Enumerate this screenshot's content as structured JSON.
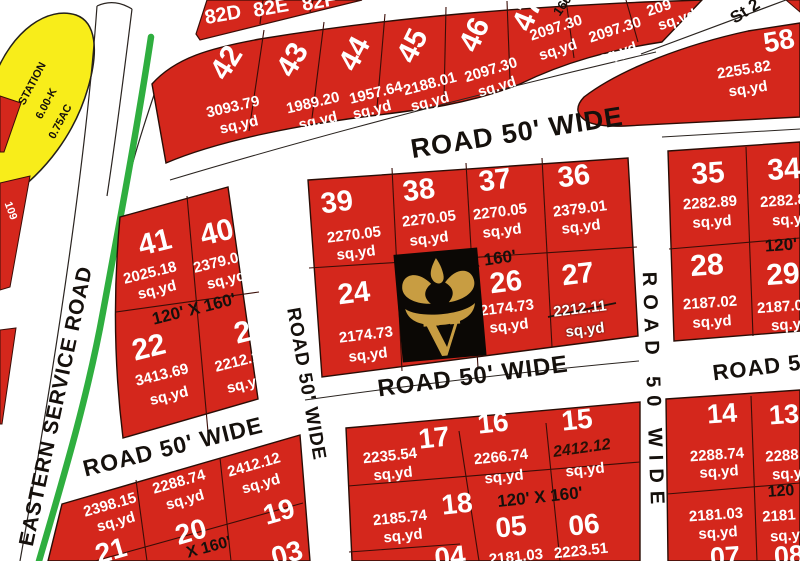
{
  "station": {
    "line1": "STATION",
    "line2": "6.00-K",
    "line3": "0.75AC"
  },
  "left_edge_plot": "109",
  "top_strip": {
    "p1": "82D",
    "p2": "82E",
    "p3": "82F"
  },
  "streets": {
    "eastern_service_road": "EASTERN SERVICE ROAD",
    "top_road": "ROAD 50' WIDE",
    "center_road": "ROAD 50' WIDE",
    "center_road_right": "ROAD 5",
    "mid_vertical_road": "ROAD 50' WIDE",
    "right_vertical_road": "ROAD 50 WIDE",
    "bottom_left_road": "ROAD 50' WIDE",
    "street_top_right": "St 2"
  },
  "dimensions": {
    "top_block": "160'",
    "block_41": "120' X 160'",
    "block_center": "X 160'",
    "block_right": "120'",
    "block_bottom_left": "X 160'",
    "block_bottom_center": "120' X 160'",
    "block_bottom_right": "120"
  },
  "plots": {
    "p42": {
      "num": "42",
      "area": "3093.79",
      "unit": "sq.yd"
    },
    "p43": {
      "num": "43",
      "area": "1989.20",
      "unit": "sq.yd"
    },
    "p44": {
      "num": "44",
      "area": "1957.64",
      "unit": "sq.yd"
    },
    "p45": {
      "num": "45",
      "area": "2188.01",
      "unit": "sq.yd"
    },
    "p46": {
      "num": "46",
      "area": "2097.30",
      "unit": "sq.yd"
    },
    "p47": {
      "num": "47",
      "area": "2097.30",
      "unit": "sq.yd"
    },
    "p48": {
      "area": "2097.30",
      "unit": "sq.yd"
    },
    "p49": {
      "area": "209",
      "unit": "sq.yd"
    },
    "p58": {
      "num": "58",
      "area": "2255.82",
      "unit": "sq.yd"
    },
    "p41": {
      "num": "41",
      "area": "2025.18",
      "unit": "sq.yd"
    },
    "p40": {
      "num": "40",
      "area": "2379.01",
      "unit": "sq.yd"
    },
    "p22": {
      "num": "22",
      "area": "3413.69",
      "unit": "sq.yd"
    },
    "p23": {
      "num": "23",
      "area": "2212.11",
      "unit": "sq.yd"
    },
    "p39": {
      "num": "39",
      "area": "2270.05",
      "unit": "sq.yd"
    },
    "p38": {
      "num": "38",
      "area": "2270.05",
      "unit": "sq.yd"
    },
    "p37": {
      "num": "37",
      "area": "2270.05",
      "unit": "sq.yd"
    },
    "p36": {
      "num": "36",
      "area": "2379.01",
      "unit": "sq.yd"
    },
    "p24": {
      "num": "24",
      "area": "2174.73",
      "unit": "sq.yd"
    },
    "p26": {
      "num": "26",
      "area": "2174.73",
      "unit": "sq.yd"
    },
    "p27": {
      "num": "27",
      "area": "2212.11",
      "unit": "sq.yd"
    },
    "p35": {
      "num": "35",
      "area": "2282.89",
      "unit": "sq.yd"
    },
    "p34": {
      "num": "34",
      "area": "2282.8",
      "unit": "sq.y"
    },
    "p28": {
      "num": "28",
      "area": "2187.02",
      "unit": "sq.yd"
    },
    "p29": {
      "num": "29",
      "area": "2187.0",
      "unit": "sq.y"
    },
    "p21": {
      "num": "21",
      "area": "2398.15",
      "unit": "sq.yd"
    },
    "p20": {
      "num": "20",
      "area": "2288.74",
      "unit": "sq.yd"
    },
    "p19": {
      "num": "19",
      "area": "2412.12",
      "unit": "sq.yd"
    },
    "p03": {
      "num": "03"
    },
    "p17": {
      "num": "17",
      "area": "2235.54",
      "unit": "sq.yd"
    },
    "p16": {
      "num": "16",
      "area": "2266.74",
      "unit": "sq.yd"
    },
    "p15": {
      "num": "15",
      "area": "2412.12",
      "unit": "sq.yd"
    },
    "p18": {
      "num": "18",
      "area": "2185.74",
      "unit": "sq.yd"
    },
    "p04": {
      "num": "04"
    },
    "p05": {
      "num": "05",
      "area": "2181.03"
    },
    "p06": {
      "num": "06",
      "area": "2223.51"
    },
    "p14": {
      "num": "14",
      "area": "2288.74",
      "unit": "sq.yd"
    },
    "p13": {
      "num": "13",
      "area": "2288",
      "unit": "sq.y"
    },
    "p07": {
      "num": "07",
      "area": "2181.03",
      "unit": "sq.yd"
    },
    "p08": {
      "num": "08",
      "area": "2181",
      "unit": "sq.y"
    }
  },
  "logo": {
    "letter": "V"
  },
  "colors": {
    "plot_red": "#d4271c",
    "station_yellow": "#f8ed1a",
    "boundary_green": "#2fae3f",
    "logo_gold": "#c89d42"
  }
}
